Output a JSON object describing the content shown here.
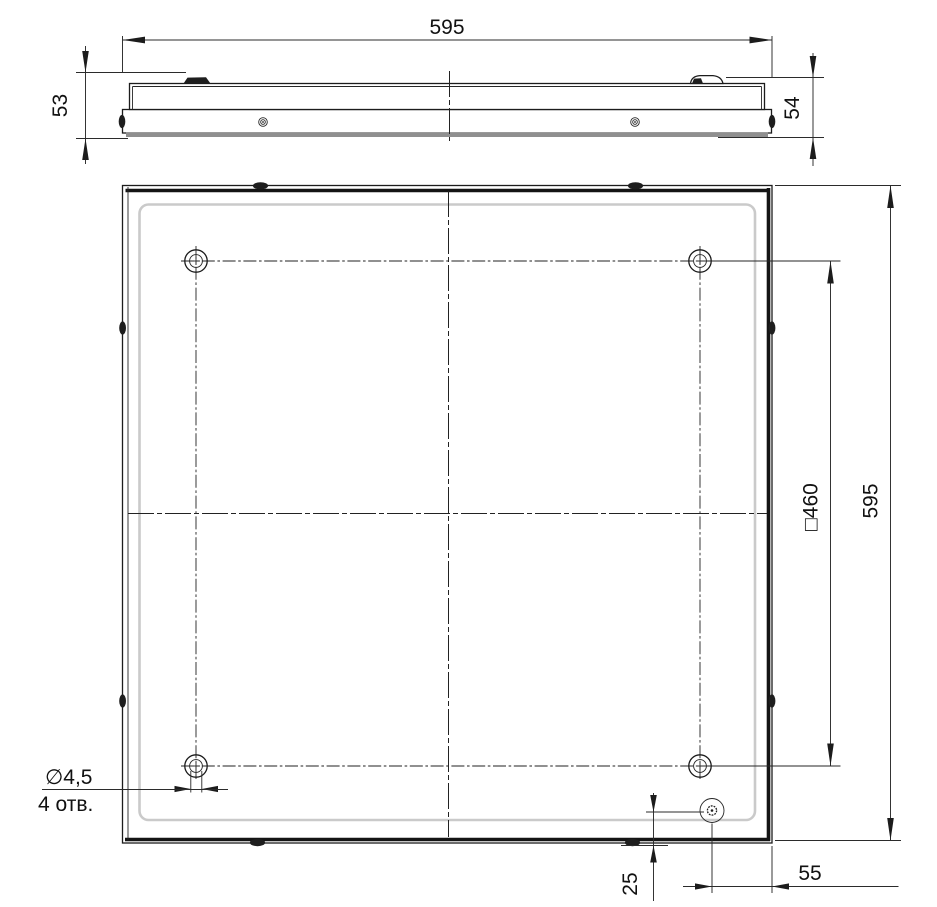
{
  "drawing": {
    "type": "technical-drawing",
    "views": {
      "side_view": {
        "dim_width": "595",
        "dim_height_left": "53",
        "dim_height_right": "54"
      },
      "plan_view": {
        "dim_height": "595",
        "dim_mounting_square": "□460",
        "hole_callout_diameter": "∅4,5",
        "hole_callout_count": "4 отв.",
        "dim_offset_bottom": "25",
        "dim_offset_right": "55"
      }
    },
    "colors": {
      "line": "#1c1c1c",
      "dimension_line": "#2b2b2b",
      "diffuser_edge": "#cacaca",
      "gasket_gray": "#8f8f8f",
      "background": "#ffffff"
    }
  }
}
